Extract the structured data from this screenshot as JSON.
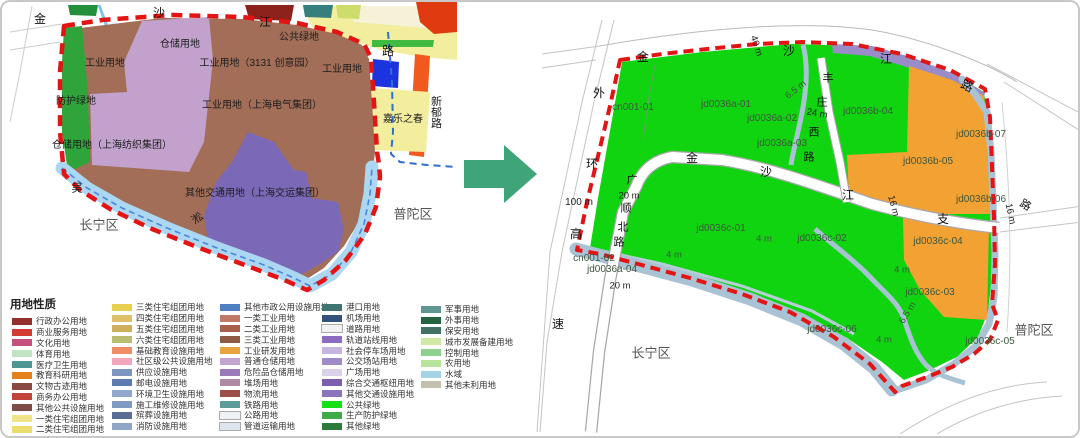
{
  "palette": {
    "boundary_red": "#e21414",
    "river_left": "#abd7f2",
    "river_right": "#a9c2d4",
    "parcel_green": "#11d411",
    "parcel_orange": "#f2a232",
    "industry_brown": "#a26e58",
    "warehouse_purple": "#c2a2cd",
    "transport_purple": "#7b68b6",
    "protect_green": "#2fa43b",
    "rail_purple": "#9a8cc8",
    "arrow_green": "#3fa578",
    "blue_dash": "#2f6fd0"
  },
  "arrow": {
    "name": "transform-arrow",
    "color": "#3fa578",
    "direction": "right"
  },
  "left_map": {
    "labels": [
      {
        "t": "金",
        "x": 38,
        "y": 17,
        "s": 12,
        "c": "#111",
        "n": "road-label-jinshajiang"
      },
      {
        "t": "沙",
        "x": 157,
        "y": 11,
        "s": 12,
        "c": "#111"
      },
      {
        "t": "江",
        "x": 263,
        "y": 20,
        "s": 12,
        "c": "#111"
      },
      {
        "t": "路",
        "x": 386,
        "y": 49,
        "s": 12,
        "c": "#111"
      },
      {
        "t": "仓储用地",
        "x": 178,
        "y": 43
      },
      {
        "t": "公共绿地",
        "x": 297,
        "y": 36
      },
      {
        "t": "工业用地",
        "x": 103,
        "y": 62
      },
      {
        "t": "工业用地（3131 创意园）",
        "x": 255,
        "y": 62
      },
      {
        "t": "工业用地",
        "x": 340,
        "y": 68
      },
      {
        "t": "防护绿地",
        "x": 74,
        "y": 100
      },
      {
        "t": "工业用地（上海电气集团）",
        "x": 260,
        "y": 104
      },
      {
        "t": "嘉乐之春",
        "x": 401,
        "y": 118
      },
      {
        "t": "新郁路",
        "x": 433,
        "y": 110,
        "v": true,
        "s": 11,
        "n": "road-label-xinyu"
      },
      {
        "t": "仓储用地（上海纺织集团）",
        "x": 110,
        "y": 144
      },
      {
        "t": "其他交通用地（上海交运集团）",
        "x": 253,
        "y": 192
      },
      {
        "t": "吴",
        "x": 75,
        "y": 187,
        "s": 11,
        "n": "river-label-wusong"
      },
      {
        "t": "淞",
        "x": 196,
        "y": 217,
        "s": 11,
        "r": -35
      },
      {
        "t": "长宁区",
        "x": 97,
        "y": 223,
        "s": 13,
        "c": "#555",
        "n": "district-changning"
      },
      {
        "t": "普陀区",
        "x": 411,
        "y": 212,
        "s": 13,
        "c": "#555",
        "n": "district-putuo"
      }
    ]
  },
  "right_map": {
    "labels": [
      {
        "t": "金",
        "x": 641,
        "y": 55,
        "s": 12,
        "c": "#111",
        "n": "road-label-jinshajiang"
      },
      {
        "t": "沙",
        "x": 787,
        "y": 49,
        "s": 12,
        "c": "#111"
      },
      {
        "t": "江",
        "x": 884,
        "y": 57,
        "s": 12,
        "c": "#111"
      },
      {
        "t": "路",
        "x": 965,
        "y": 84,
        "s": 12,
        "c": "#111",
        "r": 25
      },
      {
        "t": "40 m",
        "x": 754,
        "y": 44,
        "s": 9.5,
        "c": "#222",
        "r": 72
      },
      {
        "t": "外",
        "x": 597,
        "y": 91,
        "s": 12,
        "c": "#111",
        "n": "road-label-waihuan"
      },
      {
        "t": "环",
        "x": 590,
        "y": 162,
        "s": 12,
        "c": "#111"
      },
      {
        "t": "高",
        "x": 574,
        "y": 232,
        "s": 12,
        "c": "#111"
      },
      {
        "t": "速",
        "x": 556,
        "y": 322,
        "s": 12,
        "c": "#111"
      },
      {
        "t": "100 m",
        "x": 577,
        "y": 201,
        "s": 10,
        "c": "#222"
      },
      {
        "t": "丰",
        "x": 826,
        "y": 77,
        "s": 11,
        "c": "#111",
        "n": "road-label-fengzhuangxi"
      },
      {
        "t": "庄",
        "x": 820,
        "y": 101,
        "s": 11,
        "c": "#111"
      },
      {
        "t": "西",
        "x": 812,
        "y": 131,
        "s": 11,
        "c": "#111"
      },
      {
        "t": "路",
        "x": 807,
        "y": 156,
        "s": 11,
        "c": "#111"
      },
      {
        "t": "24 m",
        "x": 815,
        "y": 112,
        "s": 9.5,
        "c": "#222",
        "r": 10
      },
      {
        "t": "广",
        "x": 630,
        "y": 179,
        "s": 11,
        "c": "#111",
        "n": "road-label-guangshunbei"
      },
      {
        "t": "顺",
        "x": 624,
        "y": 207,
        "s": 11,
        "c": "#111"
      },
      {
        "t": "北",
        "x": 621,
        "y": 226,
        "s": 11,
        "c": "#111"
      },
      {
        "t": "路",
        "x": 617,
        "y": 241,
        "s": 11,
        "c": "#111"
      },
      {
        "t": "20 m",
        "x": 627,
        "y": 194,
        "s": 9.5,
        "c": "#222"
      },
      {
        "t": "金",
        "x": 690,
        "y": 156,
        "s": 12,
        "c": "#111",
        "n": "road-label-jinshajiang-zhilu"
      },
      {
        "t": "沙",
        "x": 764,
        "y": 170,
        "s": 12,
        "c": "#111"
      },
      {
        "t": "江",
        "x": 846,
        "y": 193,
        "s": 12,
        "c": "#111"
      },
      {
        "t": "支",
        "x": 941,
        "y": 217,
        "s": 12,
        "c": "#111"
      },
      {
        "t": "16 m",
        "x": 891,
        "y": 204,
        "s": 9.5,
        "c": "#222",
        "r": 75
      },
      {
        "t": "16 m",
        "x": 1008,
        "y": 212,
        "s": 9.5,
        "c": "#222",
        "r": 78
      },
      {
        "t": "路",
        "x": 1023,
        "y": 204,
        "s": 11,
        "c": "#111",
        "r": 30
      },
      {
        "t": "cn001-01",
        "x": 631,
        "y": 106,
        "c": "#3c563c",
        "n": "parcel-label-cn001-01"
      },
      {
        "t": "jd0036a-01",
        "x": 724,
        "y": 103,
        "c": "#3c563c",
        "n": "parcel-label-jd0036a-01"
      },
      {
        "t": "jd0036a-02",
        "x": 770,
        "y": 117,
        "c": "#3c563c",
        "n": "parcel-label-jd0036a-02"
      },
      {
        "t": "jd0036a-03",
        "x": 780,
        "y": 142,
        "c": "#3c563c",
        "n": "parcel-label-jd0036a-03"
      },
      {
        "t": "jd0036b-04",
        "x": 866,
        "y": 110,
        "c": "#3c563c",
        "n": "parcel-label-jd0036b-04"
      },
      {
        "t": "jd0036b-07",
        "x": 979,
        "y": 133,
        "c": "#3c563c",
        "n": "parcel-label-jd0036b-07"
      },
      {
        "t": "jd0036b-05",
        "x": 926,
        "y": 160,
        "c": "#3c563c",
        "n": "parcel-label-jd0036b-05"
      },
      {
        "t": "jd0036b-06",
        "x": 979,
        "y": 198,
        "c": "#3c563c",
        "n": "parcel-label-jd0036b-06"
      },
      {
        "t": "jd0036c-01",
        "x": 719,
        "y": 227,
        "c": "#3c563c",
        "n": "parcel-label-jd0036c-01"
      },
      {
        "t": "jd0036c-02",
        "x": 820,
        "y": 237,
        "c": "#3c563c",
        "n": "parcel-label-jd0036c-02"
      },
      {
        "t": "jd0036c-04",
        "x": 936,
        "y": 240,
        "c": "#3c563c",
        "n": "parcel-label-jd0036c-04"
      },
      {
        "t": "jd0036c-03",
        "x": 928,
        "y": 291,
        "c": "#3c563c",
        "n": "parcel-label-jd0036c-03"
      },
      {
        "t": "jd0036c-06",
        "x": 830,
        "y": 328,
        "c": "#3c563c",
        "n": "parcel-label-jd0036c-06"
      },
      {
        "t": "jd0036c-05",
        "x": 988,
        "y": 340,
        "c": "#3c563c",
        "n": "parcel-label-jd0036c-05"
      },
      {
        "t": "cn001-02",
        "x": 592,
        "y": 257,
        "c": "#3c563c",
        "n": "parcel-label-cn001-02"
      },
      {
        "t": "jd0036a-04",
        "x": 610,
        "y": 268,
        "c": "#3c563c",
        "n": "parcel-label-jd0036a-04"
      },
      {
        "t": "6.5 m",
        "x": 794,
        "y": 88,
        "s": 9.5,
        "c": "#3c563c",
        "r": -38
      },
      {
        "t": "6.5 m",
        "x": 906,
        "y": 311,
        "s": 9.5,
        "c": "#3c563c",
        "r": -58
      },
      {
        "t": "4 m",
        "x": 762,
        "y": 237,
        "s": 9.5,
        "c": "#3c563c"
      },
      {
        "t": "4 m",
        "x": 672,
        "y": 253,
        "s": 9.5,
        "c": "#3c563c"
      },
      {
        "t": "4 m",
        "x": 900,
        "y": 268,
        "s": 9.5,
        "c": "#3c563c"
      },
      {
        "t": "4 m",
        "x": 882,
        "y": 338,
        "s": 9.5,
        "c": "#3c563c"
      },
      {
        "t": "20 m",
        "x": 618,
        "y": 284,
        "s": 9.5,
        "c": "#222"
      },
      {
        "t": "长宁区",
        "x": 649,
        "y": 351,
        "s": 13,
        "c": "#555",
        "n": "district-changning"
      },
      {
        "t": "普陀区",
        "x": 1032,
        "y": 328,
        "s": 13,
        "c": "#555",
        "n": "district-putuo"
      }
    ]
  },
  "legend": {
    "title": "用地性质",
    "columns": [
      {
        "x": 2,
        "y": 20,
        "items": [
          {
            "label": "行政办公用地",
            "color": "#93302a"
          },
          {
            "label": "商业服务用地",
            "color": "#d23b32"
          },
          {
            "label": "文化用地",
            "color": "#c64f7e"
          },
          {
            "label": "体育用地",
            "color": "#bfe3c3"
          },
          {
            "label": "医疗卫生用地",
            "color": "#4d9693"
          },
          {
            "label": "教育科研用地",
            "color": "#e5801c"
          },
          {
            "label": "文物古迹用地",
            "color": "#8a4a41"
          },
          {
            "label": "商务办公用地",
            "color": "#c2453c"
          },
          {
            "label": "其他公共设施用地",
            "color": "#7d4a45"
          },
          {
            "label": "一类住宅组团用地",
            "color": "#f1e387"
          },
          {
            "label": "二类住宅组团用地",
            "color": "#ecdc6d"
          }
        ]
      },
      {
        "x": 102,
        "y": 6,
        "items": [
          {
            "label": "三类住宅组团用地",
            "color": "#e7d04f"
          },
          {
            "label": "四类住宅组团用地",
            "color": "#dec06a"
          },
          {
            "label": "五类住宅组团用地",
            "color": "#cfae5e"
          },
          {
            "label": "六类住宅组团用地",
            "color": "#b9bd72"
          },
          {
            "label": "基础教育设施用地",
            "color": "#ef8d66"
          },
          {
            "label": "社区级公共设施用地",
            "color": "#f2a6bb"
          },
          {
            "label": "供应设施用地",
            "color": "#7e97c0"
          },
          {
            "label": "邮电设施用地",
            "color": "#5c7cb0"
          },
          {
            "label": "环境卫生设施用地",
            "color": "#93a9cc"
          },
          {
            "label": "施工维修设施用地",
            "color": "#7f9bc2"
          },
          {
            "label": "殡葬设施用地",
            "color": "#5a6d94"
          },
          {
            "label": "消防设施用地",
            "color": "#8fa6c6"
          }
        ]
      },
      {
        "x": 210,
        "y": 6,
        "items": [
          {
            "label": "其他市政公用设施用地",
            "color": "#4e7fc0"
          },
          {
            "label": "一类工业用地",
            "color": "#c07a67"
          },
          {
            "label": "二类工业用地",
            "color": "#a8604d"
          },
          {
            "label": "三类工业用地",
            "color": "#8f5a44"
          },
          {
            "label": "工业研发用地",
            "color": "#e9a33f"
          },
          {
            "label": "普通仓储用地",
            "color": "#c3a3cf"
          },
          {
            "label": "危险品仓储用地",
            "color": "#9a7ab8"
          },
          {
            "label": "堆场用地",
            "color": "#b089a6"
          },
          {
            "label": "物流用地",
            "color": "#9c4f48"
          },
          {
            "label": "铁路用地",
            "color": "#5d9b98"
          },
          {
            "label": "公路用地",
            "color": "#eef2f6",
            "border": true
          },
          {
            "label": "管道运输用地",
            "color": "#dfe5ee",
            "border": true
          }
        ]
      },
      {
        "x": 312,
        "y": 6,
        "items": [
          {
            "label": "港口用地",
            "color": "#3f7472"
          },
          {
            "label": "机场用地",
            "color": "#32527c"
          },
          {
            "label": "道路用地",
            "color": "#f2f2f2",
            "border": true
          },
          {
            "label": "轨道站线用地",
            "color": "#8d6cc0"
          },
          {
            "label": "社会停车场用地",
            "color": "#c6b5de"
          },
          {
            "label": "公交场站用地",
            "color": "#a18ac8"
          },
          {
            "label": "广场用地",
            "color": "#d9d2ea"
          },
          {
            "label": "综合交通枢纽用地",
            "color": "#7e5fae"
          },
          {
            "label": "其他交通设施用地",
            "color": "#8b74bc"
          },
          {
            "label": "公共绿地",
            "color": "#14e014"
          },
          {
            "label": "生产防护绿地",
            "color": "#3faa48"
          },
          {
            "label": "其他绿地",
            "color": "#2c7a3c"
          }
        ]
      },
      {
        "x": 411,
        "y": 8,
        "items": [
          {
            "label": "军事用地",
            "color": "#5f9693"
          },
          {
            "label": "外事用地",
            "color": "#22643f"
          },
          {
            "label": "保安用地",
            "color": "#40725f"
          },
          {
            "label": "城市发展备建用地",
            "color": "#cfe8a4"
          },
          {
            "label": "控制用地",
            "color": "#8ed08e"
          },
          {
            "label": "农用地",
            "color": "#b7e39a"
          },
          {
            "label": "水域",
            "color": "#a2d4e5"
          },
          {
            "label": "其他未利用地",
            "color": "#c3bfad"
          }
        ]
      }
    ]
  }
}
